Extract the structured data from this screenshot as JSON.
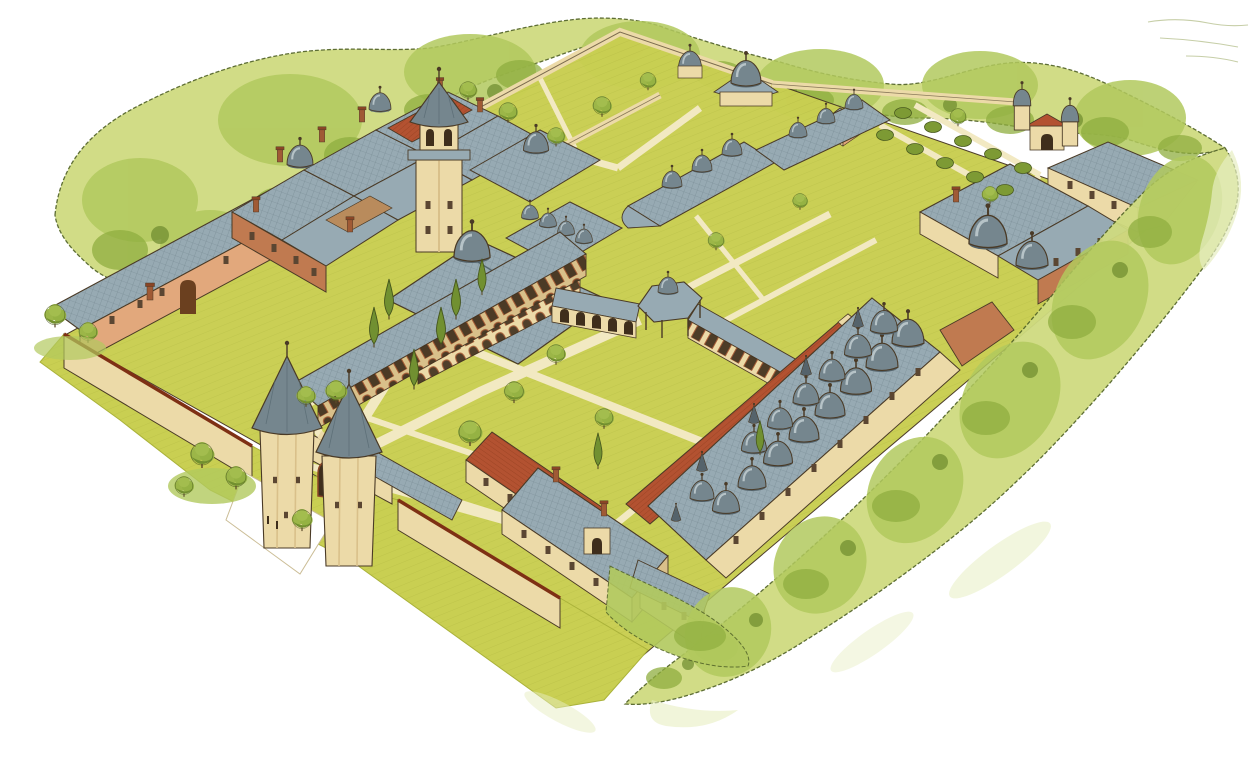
{
  "meta": {
    "title": "Aerial watercolor illustration of an Ottoman palace complex (Topkapi Palace reconstruction)",
    "description": "Bird's-eye three-quarter view of a walled palace compound on a white background. A belt of yellow-green trees surrounds cream outer walls. Inside are lawned courtyards crossed by pale paths with cypress and round trees, dense clusters of grey hipped roofs, lead-grey domes, red tiled roofs and brick chimneys. A twin-towered gate with conical roofs stands in the lower-left wall; a tall square tower with a pointed spire rises left of centre; a long kitchen range with two rows of domes and chimney cones runs along the lower-right side.",
    "type": "illustration",
    "interactive": false
  },
  "palette": {
    "paper": "#ffffff",
    "foliage_light": "#cfdb80",
    "foliage_mid": "#b2c95e",
    "foliage_dark": "#8fae3f",
    "foliage_deep": "#6d8a2e",
    "foliage_outline": "#55662a",
    "wash": "#e7eec2",
    "lawn": "#c9cf52",
    "lawn_shade": "#aab23a",
    "path_cream": "#f2e9c2",
    "wall_cream": "#ecdaa8",
    "wall_shadow": "#d9c08a",
    "wall_salmon": "#e2a87c",
    "brick": "#c07a50",
    "brick_dark": "#a05a35",
    "red_roof": "#b35231",
    "red_roof_dark": "#7e3014",
    "roof_gray": "#97aab3",
    "roof_line": "#54676f",
    "dome_gray": "#75868e",
    "dome_dark": "#55646c",
    "dome_hi": "#c7d2d6",
    "ink": "#4a3a26",
    "window_dark": "#5b4632"
  },
  "scene": {
    "setting": "walled palace complex viewed from above, oriented as a diamond, tree belt outside the walls, blank white page around",
    "landmarks": [
      {
        "name": "gate-of-salutation",
        "desc": "twin octagonal towers with conical grey roofs flanking a crenellated arched gate in the south-west wall"
      },
      {
        "name": "tower-of-justice",
        "desc": "tall square tower with lantern and pointed spire left of centre"
      },
      {
        "name": "divan-hall",
        "desc": "large hipped roof with dome and arcaded front on the second courtyard"
      },
      {
        "name": "second-courtyard",
        "desc": "lawns crossed by radiating cream paths, cypresses and round trees"
      },
      {
        "name": "gate-of-felicity",
        "desc": "small domed canopy on columns between two arcades"
      },
      {
        "name": "palace-kitchens",
        "desc": "long range on the south-east side carrying two rows of grey domes with conical chimney caps and a parallel red tiled roof"
      },
      {
        "name": "harem-complex",
        "desc": "dense cluster of grey roofs, domes and chimneys over brick walls, north-west"
      },
      {
        "name": "first-courtyard",
        "desc": "two walled lawn enclosures with trees at the north corner"
      },
      {
        "name": "fourth-courtyard-gardens",
        "desc": "hedge rows and pavilions towards the east corner with a twin-turreted garden gate"
      },
      {
        "name": "stables-range",
        "desc": "long salmon building with grey roof along the north-west wall"
      },
      {
        "name": "tree-belt",
        "desc": "irregular band of yellow-green foliage hugging the outside of the walls, fading to loose washes"
      }
    ]
  }
}
